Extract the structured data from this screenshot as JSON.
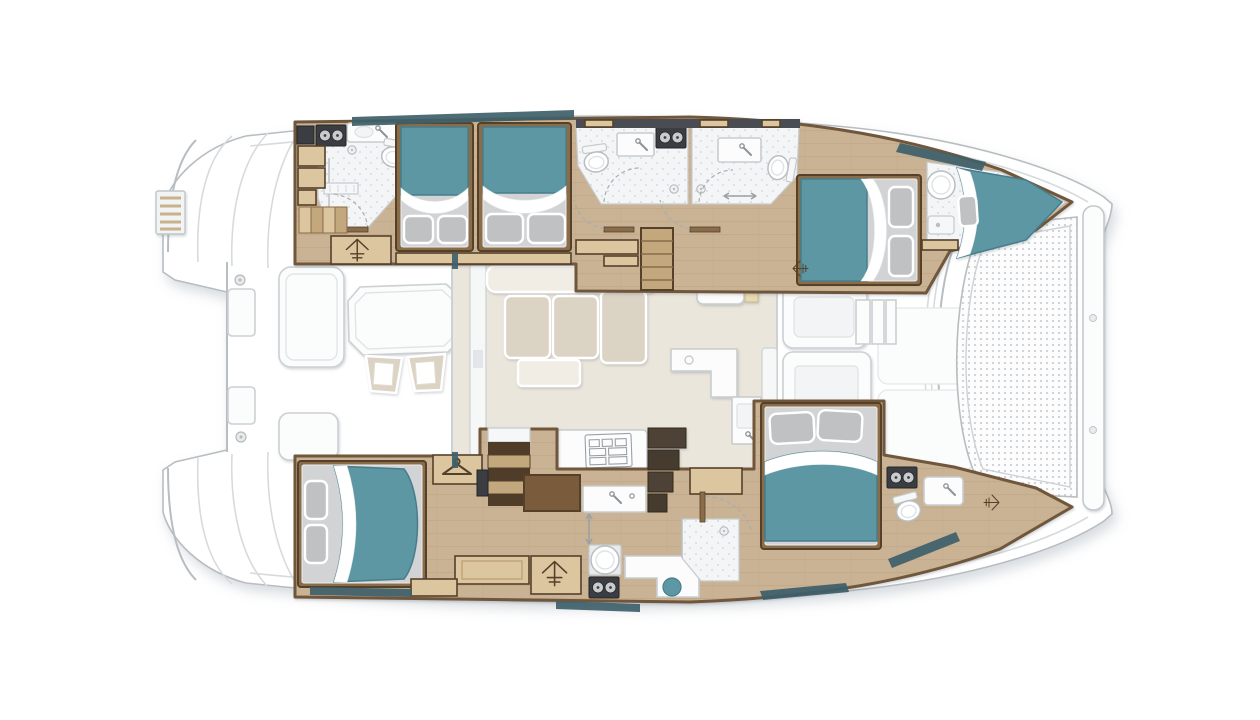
{
  "meta": {
    "title": "Catamaran interior deck plan, top-down view, bow to the right",
    "view": "top-down",
    "bow_direction": "right"
  },
  "palette": {
    "page_bg": "#ffffff",
    "hull_white": "#ffffff",
    "outline": "#b7bdc1",
    "deck_line": "#d7dbde",
    "wood_floor": "#c9b394",
    "wood_line": "#b99f7e",
    "wall": "#6f563a",
    "trim": "#55412b",
    "step_tan": "#dcc69f",
    "step_dark": "#c3a87e",
    "bed_teal": "#5d97a4",
    "bed_teal_dark": "#477d8b",
    "sheet": "#ffffff",
    "mattress": "#d2d3d5",
    "pillow": "#bfc1c3",
    "bath_floor": "#f4f5f6",
    "speckle_dot": "#d9dcdf",
    "appliance": "#3a3e42",
    "dial": "#c9cbcd",
    "saloon_floor": "#ebe6dc",
    "sofa": "#dbd3c4",
    "sofa_light": "#f1ede5",
    "counter": "#fcfcfc",
    "counter_line": "#c9cdd0",
    "tramp_dot": "#ccd2d6",
    "window": "#3e5f6a",
    "amber": "#e8d9b0"
  },
  "plan": {
    "stern": {
      "items": [
        "swim-platform-steps-port",
        "swim-platform-steps-starboard",
        "boarding-ladder",
        "aft-crossbeam",
        "cleats",
        "transom-boxes"
      ]
    },
    "cockpit_aft": {
      "items": [
        "dining-table",
        "folding-chair",
        "folding-chair",
        "bench-seat",
        "bench-seat"
      ]
    },
    "saloon": {
      "items": [
        "sliding-door-aft",
        "l-sofa",
        "seat-cushions",
        "ottoman-table",
        "galley-counter",
        "cooktop",
        "galley-island",
        "sink",
        "nav-cabinet",
        "stairs-to-port-hull",
        "sliding-door-forward"
      ]
    },
    "port_hull": {
      "rooms": [
        "aft-head-with-shower",
        "double-berth",
        "double-berth",
        "mid-head",
        "mid-head",
        "forward-double-cabin",
        "bow-crew-berth-with-head"
      ]
    },
    "starboard_hull": {
      "rooms": [
        "owner-aft-cabin",
        "wardrobe",
        "vanity-desk",
        "stairs-down",
        "mid-head-with-shower",
        "forward-double-cabin",
        "bow-head"
      ]
    },
    "cockpit_forward": {
      "items": [
        "lounge-pad",
        "bench-seat",
        "steps",
        "bench-with-table",
        "deck-panels"
      ]
    },
    "bow": {
      "items": [
        "trampoline-mesh",
        "forward-crossbeam"
      ]
    }
  },
  "counts": {
    "double_beds": 5,
    "v_berths": 1,
    "toilets": 6,
    "round_basins": 2,
    "showers": 3,
    "staircases": 3,
    "wardrobes": 2,
    "cockpit_chairs": 2
  }
}
